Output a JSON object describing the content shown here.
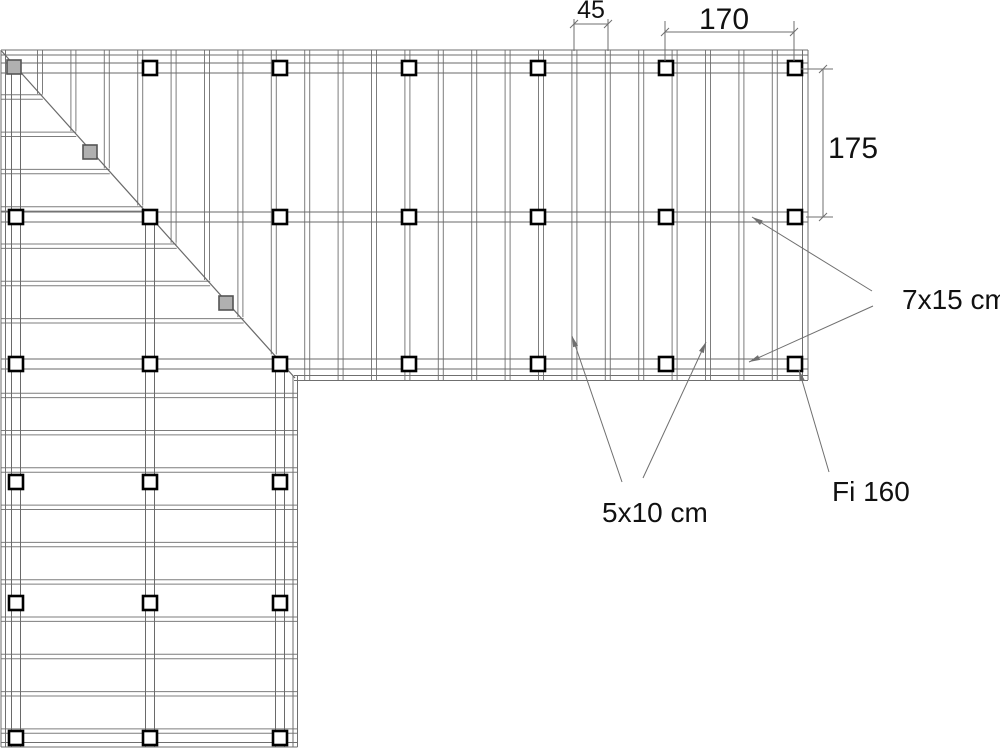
{
  "drawing": {
    "type": "framing-plan",
    "canvas": {
      "w": 1000,
      "h": 750,
      "background": "#ffffff"
    },
    "colors": {
      "thin_line": "#7d7d7d",
      "beam_line": "#6a6a6a",
      "outline": "#6f6f6f",
      "post_stroke": "#000000",
      "post_fill": "#ffffff",
      "grey_post_fill": "#b0b0b0",
      "grey_post_stroke": "#555555",
      "annotation_line": "#6f6f6f",
      "text": "#111111"
    },
    "diagonal": {
      "x1": 1.5,
      "y1": 51,
      "x2": 295,
      "y2": 378
    },
    "top_band": {
      "joists": {
        "x0": 40,
        "step": 33.4,
        "count": 23,
        "half": 2.5,
        "y_top": 50,
        "y_bottom": 380
      },
      "beam_rows": [
        68,
        217,
        364
      ],
      "beam_half": 5,
      "beam_x1": 1,
      "beam_x2": 808,
      "edge_top": [
        50,
        55
      ],
      "edge_right": [
        802.5,
        808
      ],
      "edge_bottom": [
        375.5,
        380.5
      ],
      "edge_bottom_x1": 294
    },
    "left_band": {
      "joists": {
        "y0": 97,
        "step": 37.3,
        "count": 18,
        "half": 2.2,
        "x1": 1,
        "x2": 297.5,
        "skip": [
          7
        ]
      },
      "beam_cols": [
        {
          "x": 16,
          "y1": 61
        },
        {
          "x": 150,
          "y1": 211
        },
        {
          "x": 280,
          "y1": 357
        }
      ],
      "beam_half": 4.5,
      "beam_y2": 747,
      "edge_left": [
        1,
        5.5
      ],
      "edge_bottom": [
        742.5,
        747
      ],
      "edge_right": [
        293,
        297.5
      ],
      "edge_right_y1": 375.5
    },
    "posts": {
      "size": 14,
      "stroke_width": 2.6,
      "top_rows": [
        68,
        217,
        364
      ],
      "top_cols": [
        16,
        150,
        280,
        409,
        538,
        666,
        795
      ],
      "row1_skip_col": 16,
      "left_rows": [
        482,
        603,
        738
      ],
      "left_cols": [
        16,
        150,
        280
      ]
    },
    "grey_posts": {
      "size": 14,
      "centers": [
        [
          14,
          67
        ],
        [
          90,
          152
        ],
        [
          226,
          303
        ]
      ]
    },
    "dimensions": [
      {
        "id": "dim-45",
        "label": "45",
        "orient": "h",
        "x1": 574,
        "x2": 608,
        "y": 24,
        "ext_a": [
          574,
          19,
          574,
          51
        ],
        "ext_b": [
          608,
          19,
          608,
          51
        ],
        "text_x": 591,
        "text_y": 18,
        "font": 25,
        "anchor": "middle"
      },
      {
        "id": "dim-170",
        "label": "170",
        "orient": "h",
        "x1": 665,
        "x2": 794,
        "y": 32,
        "ext_a": [
          665,
          21,
          665,
          61
        ],
        "ext_b": [
          794,
          21,
          794,
          61
        ],
        "text_x": 724,
        "text_y": 29,
        "font": 30,
        "anchor": "middle"
      },
      {
        "id": "dim-175",
        "label": "175",
        "orient": "v",
        "y1": 69,
        "y2": 217,
        "x": 823,
        "ext_a": [
          801,
          69,
          833,
          69
        ],
        "ext_b": [
          806,
          217,
          833,
          217
        ],
        "text_x": 828,
        "text_y": 158,
        "font": 30,
        "anchor": "start"
      }
    ],
    "labels": [
      {
        "id": "label-7x15",
        "text": "7x15 cm",
        "x": 902,
        "y": 309,
        "font": 28,
        "leaders": [
          {
            "from": [
              872,
              291
            ],
            "tip": [
              752,
              217
            ]
          },
          {
            "from": [
              873,
              306
            ],
            "tip": [
              749,
              362
            ]
          }
        ]
      },
      {
        "id": "label-5x10",
        "text": "5x10 cm",
        "x": 602,
        "y": 522,
        "font": 28,
        "leaders": [
          {
            "from": [
              622,
              482
            ],
            "tip": [
              572,
              336
            ]
          },
          {
            "from": [
              643,
              478
            ],
            "tip": [
              706,
              342
            ]
          }
        ]
      },
      {
        "id": "label-fi160",
        "text": "Fi 160",
        "x": 832,
        "y": 501,
        "font": 28,
        "leaders": [
          {
            "from": [
              829,
              472
            ],
            "tip": [
              799,
              370
            ]
          }
        ]
      }
    ]
  }
}
